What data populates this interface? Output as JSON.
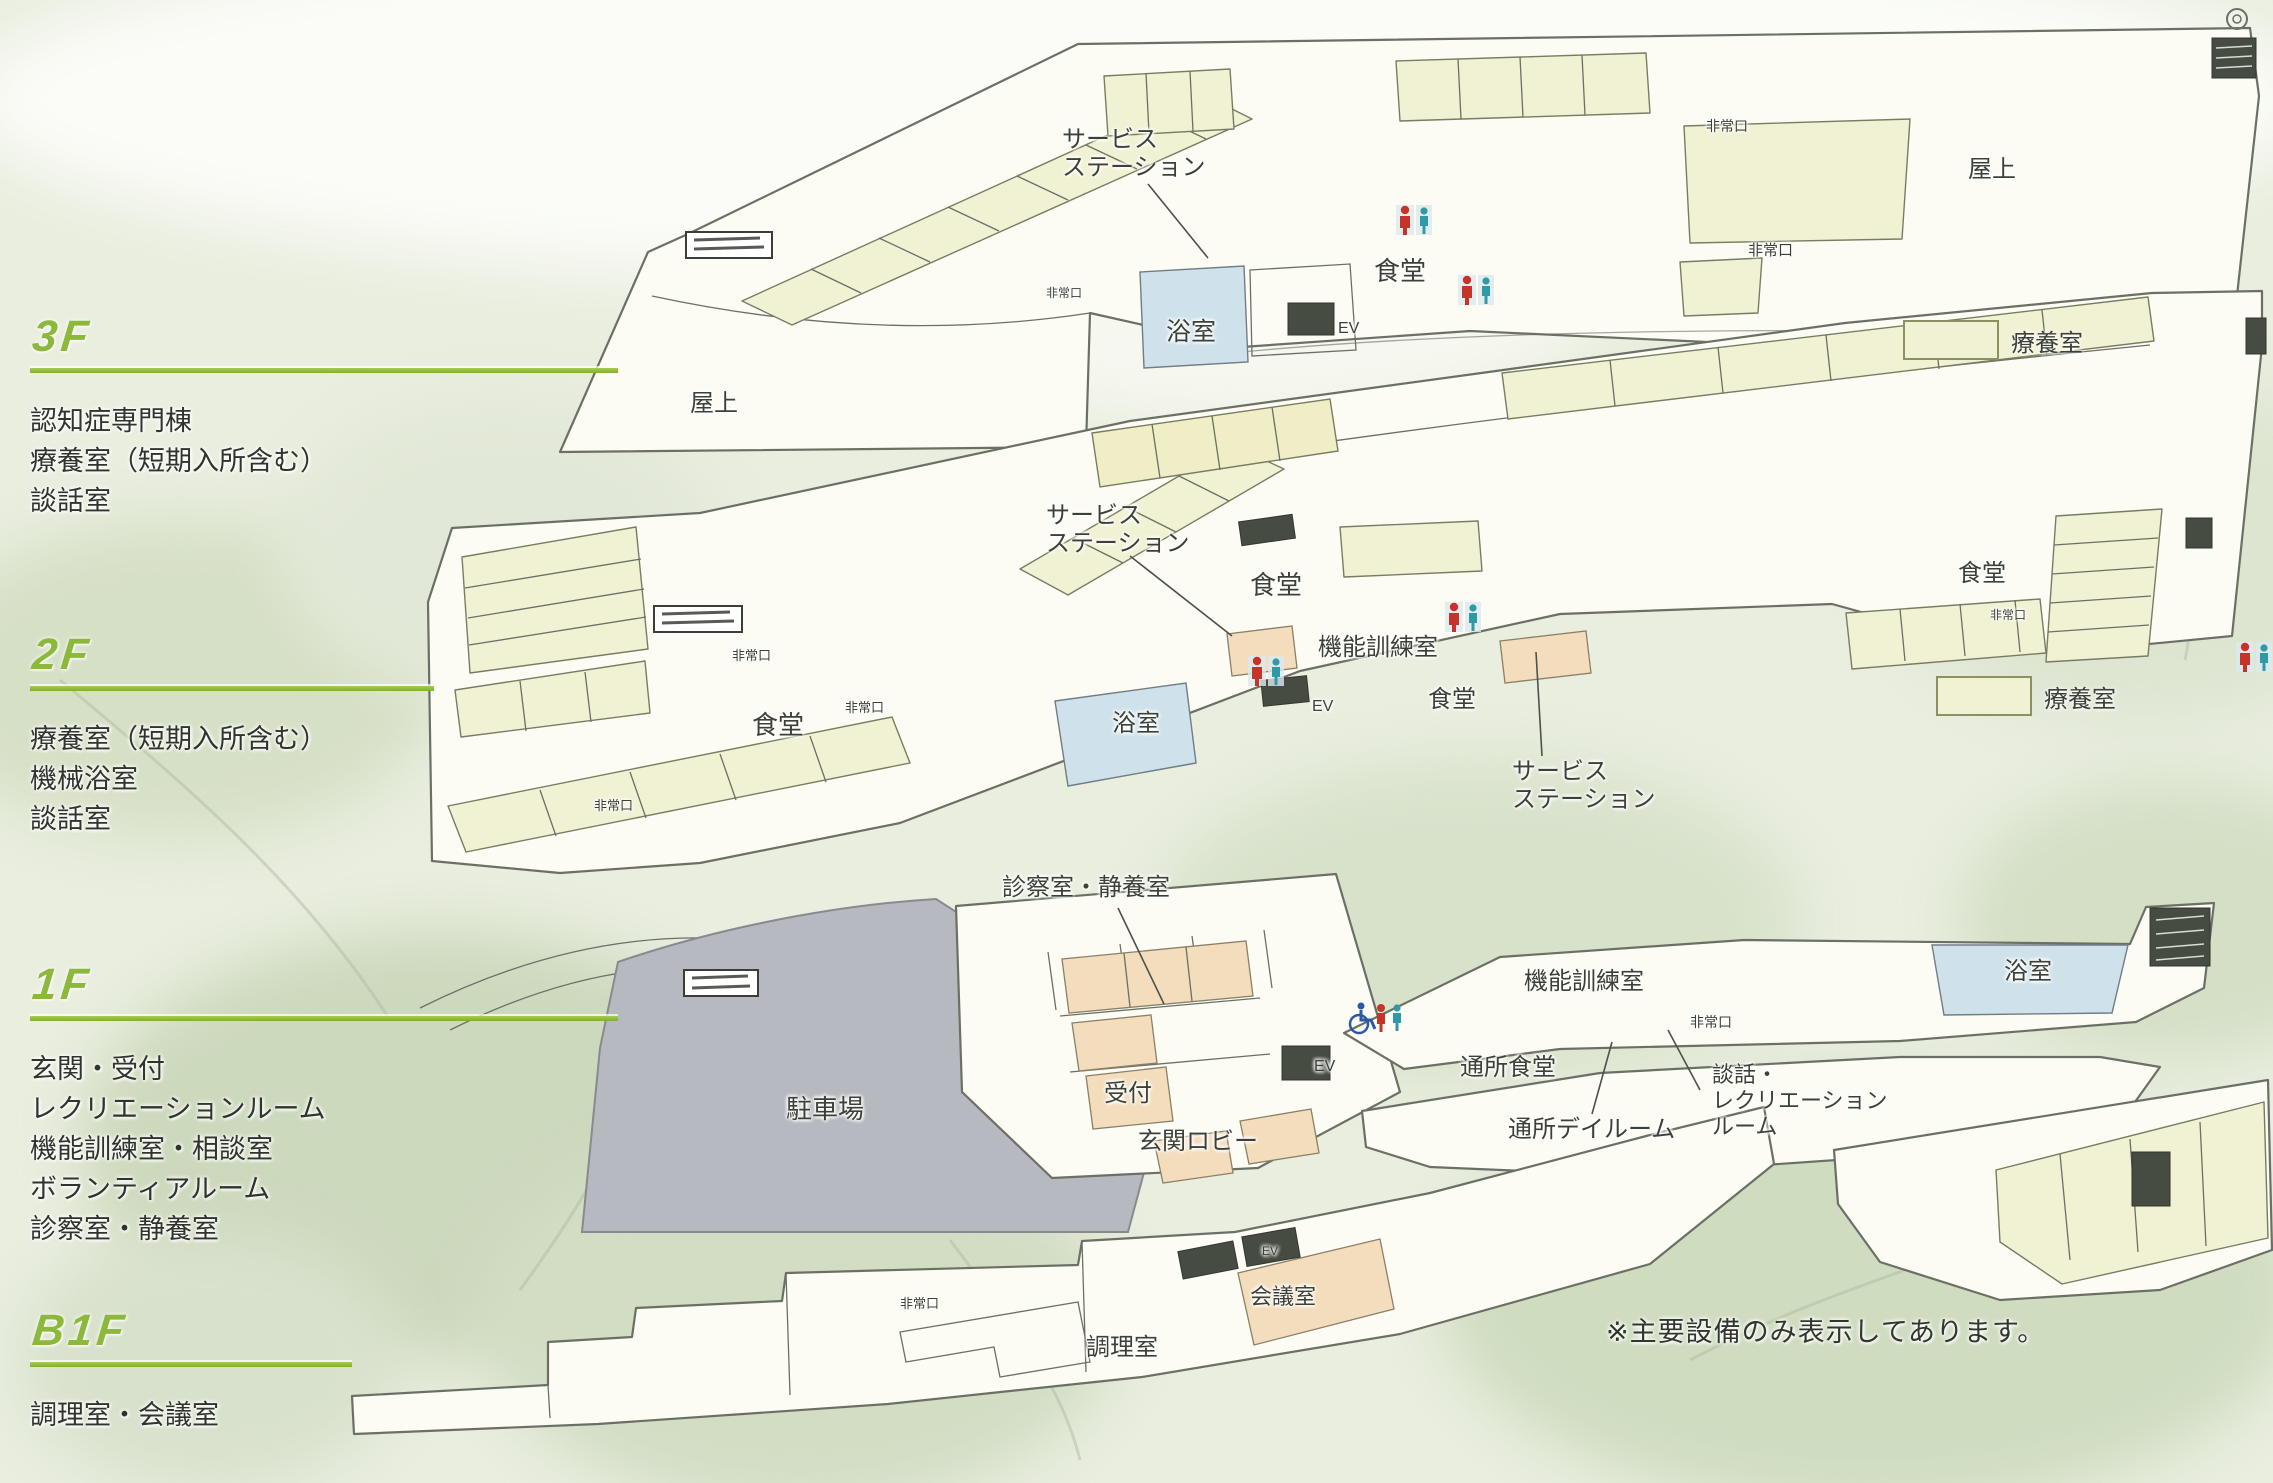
{
  "note": {
    "text": "※主要設備のみ表示してあります。",
    "x": 1606,
    "y": 1310
  },
  "legend": {
    "label": "療養室"
  },
  "colors": {
    "accent_green": "#8cb83b",
    "room_cream": "#f1f1d4",
    "room_yellow": "#efeec6",
    "bath_blue": "#cfe2eb",
    "room_orange": "#f3ddbd",
    "parking_gray": "#b6bac0",
    "outline": "#6b7065",
    "text": "#3c4137",
    "dark_box": "#474c42",
    "toilet_red": "#c5332b",
    "toilet_teal": "#2f9aa6",
    "wheelchair_blue": "#2c58a8"
  },
  "floors": [
    {
      "id": "3f",
      "label": "3F",
      "rooms": [
        "認知症専門棟",
        "療養室（短期入所含む）",
        "談話室"
      ]
    },
    {
      "id": "2f",
      "label": "2F",
      "rooms": [
        "療養室（短期入所含む）",
        "機械浴室",
        "談話室"
      ]
    },
    {
      "id": "1f",
      "label": "1F",
      "rooms": [
        "玄関・受付",
        "レクリエーションルーム",
        "機能訓練室・相談室",
        "ボランティアルーム",
        "診察室・静養室"
      ]
    },
    {
      "id": "b1f",
      "label": "B1F",
      "rooms": [
        "調理室・会議室"
      ]
    }
  ],
  "plan_labels": [
    {
      "floor": "3f",
      "name": "label-service-station-3f",
      "text": "サービス\nステーション",
      "x": 1062,
      "y": 126,
      "size": 24
    },
    {
      "floor": "3f",
      "name": "label-dining-3f",
      "text": "食堂",
      "x": 1374,
      "y": 256,
      "size": 26
    },
    {
      "floor": "3f",
      "name": "label-bath-3f",
      "text": "浴室",
      "x": 1166,
      "y": 318,
      "size": 25
    },
    {
      "floor": "3f",
      "name": "label-ev-3f",
      "text": "EV",
      "x": 1338,
      "y": 320,
      "size": 16
    },
    {
      "floor": "3f",
      "name": "label-roof-left-3f",
      "text": "屋上",
      "x": 690,
      "y": 390,
      "size": 24
    },
    {
      "floor": "3f",
      "name": "label-roof-right-3f",
      "text": "屋上",
      "x": 1968,
      "y": 156,
      "size": 24
    },
    {
      "floor": "3f",
      "name": "label-emergency-exit",
      "text": "非常口",
      "x": 1046,
      "y": 286,
      "size": 12
    },
    {
      "floor": "3f",
      "name": "label-emergency-exit",
      "text": "非常口",
      "x": 1706,
      "y": 118,
      "size": 14
    },
    {
      "floor": "3f",
      "name": "label-emergency-exit",
      "text": "非常口",
      "x": 1748,
      "y": 242,
      "size": 15
    },
    {
      "floor": "2f",
      "name": "label-service-station-2f-a",
      "text": "サービス\nステーション",
      "x": 1046,
      "y": 502,
      "size": 24
    },
    {
      "floor": "2f",
      "name": "label-service-station-2f-b",
      "text": "サービス\nステーション",
      "x": 1512,
      "y": 758,
      "size": 24
    },
    {
      "floor": "2f",
      "name": "label-dining-2f-center",
      "text": "食堂",
      "x": 1250,
      "y": 570,
      "size": 26
    },
    {
      "floor": "2f",
      "name": "label-dining-2f-left",
      "text": "食堂",
      "x": 752,
      "y": 710,
      "size": 26
    },
    {
      "floor": "2f",
      "name": "label-dining-2f-mid",
      "text": "食堂",
      "x": 1428,
      "y": 686,
      "size": 24
    },
    {
      "floor": "2f",
      "name": "label-dining-2f-right",
      "text": "食堂",
      "x": 1958,
      "y": 560,
      "size": 24
    },
    {
      "floor": "2f",
      "name": "label-training-room-2f",
      "text": "機能訓練室",
      "x": 1318,
      "y": 634,
      "size": 24
    },
    {
      "floor": "2f",
      "name": "label-bath-2f",
      "text": "浴室",
      "x": 1112,
      "y": 710,
      "size": 24
    },
    {
      "floor": "2f",
      "name": "label-ev-2f",
      "text": "EV",
      "x": 1312,
      "y": 698,
      "size": 16
    },
    {
      "floor": "2f",
      "name": "label-emergency-exit",
      "text": "非常口",
      "x": 732,
      "y": 648,
      "size": 13
    },
    {
      "floor": "2f",
      "name": "label-emergency-exit",
      "text": "非常口",
      "x": 845,
      "y": 700,
      "size": 13
    },
    {
      "floor": "2f",
      "name": "label-emergency-exit",
      "text": "非常口",
      "x": 594,
      "y": 798,
      "size": 13
    },
    {
      "floor": "2f",
      "name": "label-emergency-exit",
      "text": "非常口",
      "x": 1990,
      "y": 608,
      "size": 12
    },
    {
      "floor": "1f",
      "name": "label-exam-rest-room-1f",
      "text": "診察室・静養室",
      "x": 1002,
      "y": 874,
      "size": 24
    },
    {
      "floor": "1f",
      "name": "label-parking-1f",
      "text": "駐車場",
      "x": 786,
      "y": 1094,
      "size": 26
    },
    {
      "floor": "1f",
      "name": "label-reception-1f",
      "text": "受付",
      "x": 1104,
      "y": 1080,
      "size": 24
    },
    {
      "floor": "1f",
      "name": "label-entrance-lobby-1f",
      "text": "玄関ロビー",
      "x": 1138,
      "y": 1128,
      "size": 24
    },
    {
      "floor": "1f",
      "name": "label-training-room-1f",
      "text": "機能訓練室",
      "x": 1524,
      "y": 968,
      "size": 24
    },
    {
      "floor": "1f",
      "name": "label-daycare-dining-1f",
      "text": "通所食堂",
      "x": 1460,
      "y": 1054,
      "size": 24
    },
    {
      "floor": "1f",
      "name": "label-daycare-dayroom-1f",
      "text": "通所デイルーム",
      "x": 1508,
      "y": 1116,
      "size": 24
    },
    {
      "floor": "1f",
      "name": "label-lounge-recreation-1f",
      "text": "談話・\nレクリエーション\nルーム",
      "x": 1712,
      "y": 1062,
      "size": 22
    },
    {
      "floor": "1f",
      "name": "label-bath-1f",
      "text": "浴室",
      "x": 2004,
      "y": 958,
      "size": 24
    },
    {
      "floor": "1f",
      "name": "label-ev-1f",
      "text": "EV",
      "x": 1314,
      "y": 1058,
      "size": 16
    },
    {
      "floor": "1f",
      "name": "label-emergency-exit",
      "text": "非常口",
      "x": 1690,
      "y": 1014,
      "size": 14
    },
    {
      "floor": "b1f",
      "name": "label-kitchen-b1f",
      "text": "調理室",
      "x": 1086,
      "y": 1334,
      "size": 24
    },
    {
      "floor": "b1f",
      "name": "label-meeting-room-b1f",
      "text": "会議室",
      "x": 1250,
      "y": 1284,
      "size": 22
    },
    {
      "floor": "b1f",
      "name": "label-emergency-exit",
      "text": "非常口",
      "x": 900,
      "y": 1296,
      "size": 13
    },
    {
      "floor": "b1f",
      "name": "label-ev-b1f",
      "text": "EV",
      "x": 1262,
      "y": 1244,
      "size": 12
    }
  ],
  "icons": [
    {
      "name": "toilet-pair-icon",
      "x": 1396,
      "y": 203
    },
    {
      "name": "toilet-pair-icon",
      "x": 1458,
      "y": 273
    },
    {
      "name": "toilet-pair-icon",
      "x": 1248,
      "y": 654
    },
    {
      "name": "toilet-pair-icon",
      "x": 1445,
      "y": 600
    },
    {
      "name": "toilet-pair-icon",
      "x": 2236,
      "y": 640
    },
    {
      "name": "accessible-toilet-icon",
      "x": 1348,
      "y": 1000
    },
    {
      "name": "rooftop-vent-icon",
      "x": 2224,
      "y": 6
    }
  ]
}
